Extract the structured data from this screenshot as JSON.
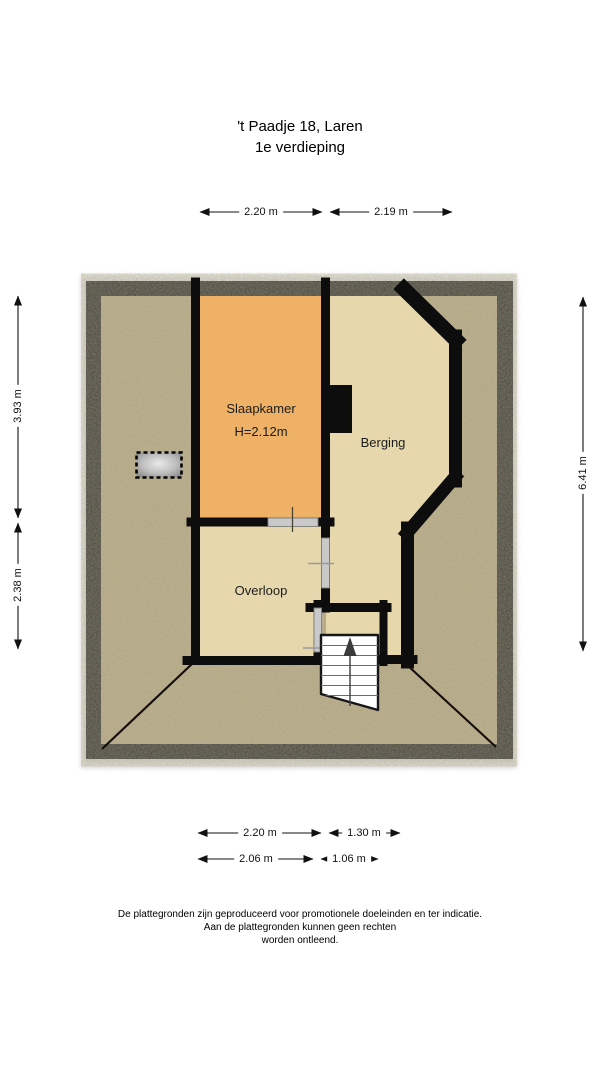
{
  "header": {
    "title_line1": "'t Paadje 18, Laren",
    "title_line2": "1e verdieping"
  },
  "floorplan": {
    "rooms": [
      {
        "name": "Slaapkamer",
        "height_label": "H=2.12m"
      },
      {
        "name": "Berging"
      },
      {
        "name": "Overloop"
      }
    ],
    "features": [
      "stairs-up",
      "skylight",
      "chimney"
    ]
  },
  "dimensions": {
    "top": [
      {
        "label": "2.20 m"
      },
      {
        "label": "2.19 m"
      }
    ],
    "left": [
      {
        "label": "3.93 m"
      },
      {
        "label": "2.38 m"
      }
    ],
    "right": [
      {
        "label": "6.41 m"
      }
    ],
    "bottom_row1": [
      {
        "label": "2.20 m"
      },
      {
        "label": "1.30 m"
      }
    ],
    "bottom_row2": [
      {
        "label": "2.06 m"
      },
      {
        "label": "1.06 m"
      }
    ]
  },
  "disclaimer": {
    "line1": "De plattegronden zijn geproduceerd voor promotionele doeleinden en ter indicatie.",
    "line2": "Aan de plattegronden kunnen geen rechten",
    "line3": "worden ontleend."
  },
  "colors": {
    "wall": "#0a0a0a",
    "attic_floor": "#b2a378",
    "room_beige": "#e6d8ac",
    "room_orange": "#eeb165",
    "stairs_fill": "#ffffff",
    "opening_gray": "#c9c9c9"
  }
}
